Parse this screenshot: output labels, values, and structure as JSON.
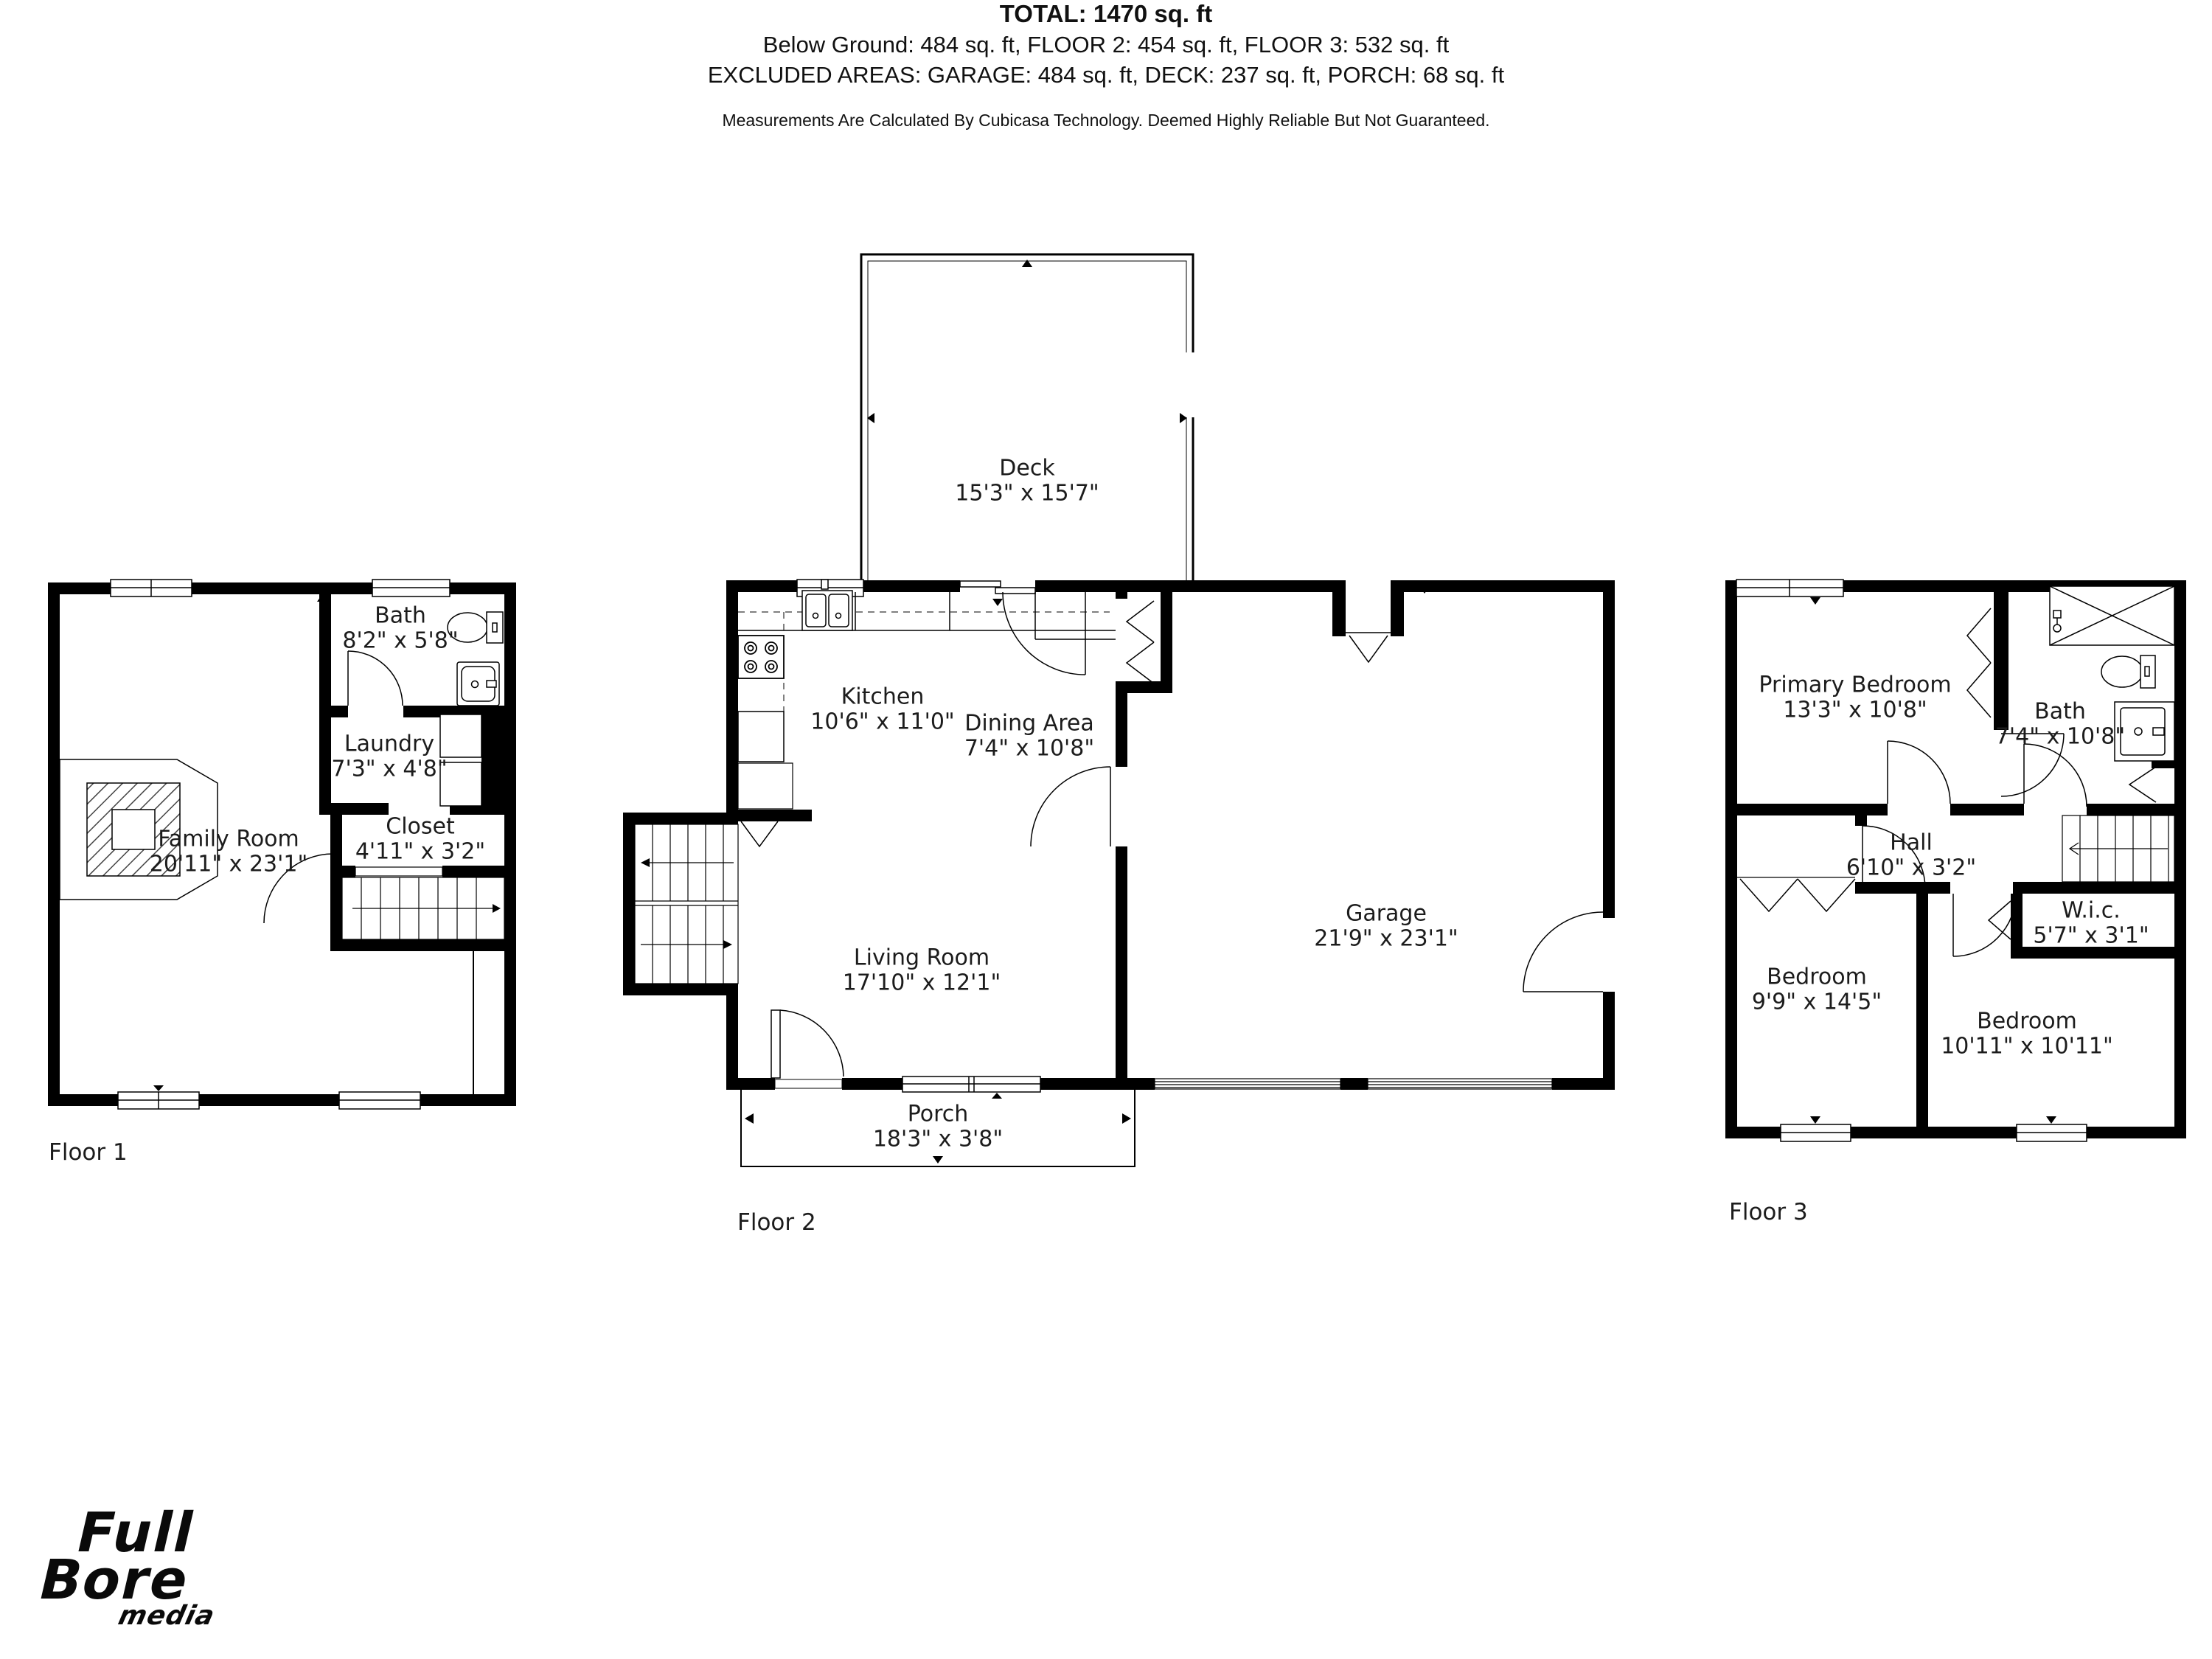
{
  "page": {
    "background": "#ffffff",
    "wall_color": "#000000",
    "text_color": "#1c1c1c"
  },
  "floors": [
    {
      "label": "Floor 1",
      "rooms": [
        {
          "name": "Bath",
          "dims": "8'2\" x 5'8\""
        },
        {
          "name": "Laundry",
          "dims": "7'3\" x 4'8\""
        },
        {
          "name": "Closet",
          "dims": "4'11\" x 3'2\""
        },
        {
          "name": "Family Room",
          "dims": "20'11\" x 23'1\""
        }
      ]
    },
    {
      "label": "Floor 2",
      "rooms": [
        {
          "name": "Deck",
          "dims": "15'3\" x 15'7\""
        },
        {
          "name": "Kitchen",
          "dims": "10'6\" x 11'0\""
        },
        {
          "name": "Dining Area",
          "dims": "7'4\" x 10'8\""
        },
        {
          "name": "Garage",
          "dims": "21'9\" x 23'1\""
        },
        {
          "name": "Living Room",
          "dims": "17'10\" x 12'1\""
        },
        {
          "name": "Porch",
          "dims": "18'3\" x 3'8\""
        }
      ]
    },
    {
      "label": "Floor 3",
      "rooms": [
        {
          "name": "Primary Bedroom",
          "dims": "13'3\" x 10'8\""
        },
        {
          "name": "Bath",
          "dims": "7'4\" x 10'8\""
        },
        {
          "name": "Hall",
          "dims": "6'10\" x 3'2\""
        },
        {
          "name": "W.i.c.",
          "dims": "5'7\" x 3'1\""
        },
        {
          "name": "Bedroom",
          "dims": "9'9\" x 14'5\""
        },
        {
          "name": "Bedroom",
          "dims": "10'11\" x 10'11\""
        }
      ]
    }
  ],
  "summary": {
    "total": "TOTAL: 1470 sq. ft",
    "floors_line": "Below Ground: 484 sq. ft, FLOOR 2: 454 sq. ft, FLOOR 3: 532 sq. ft",
    "excluded_line": "EXCLUDED AREAS: GARAGE: 484 sq. ft, DECK: 237 sq. ft, PORCH: 68 sq. ft",
    "disclaimer": "Measurements Are Calculated By Cubicasa Technology. Deemed Highly Reliable But Not Guaranteed."
  },
  "logo": {
    "word1": "Full",
    "word2": "Bore",
    "word3": "media"
  }
}
